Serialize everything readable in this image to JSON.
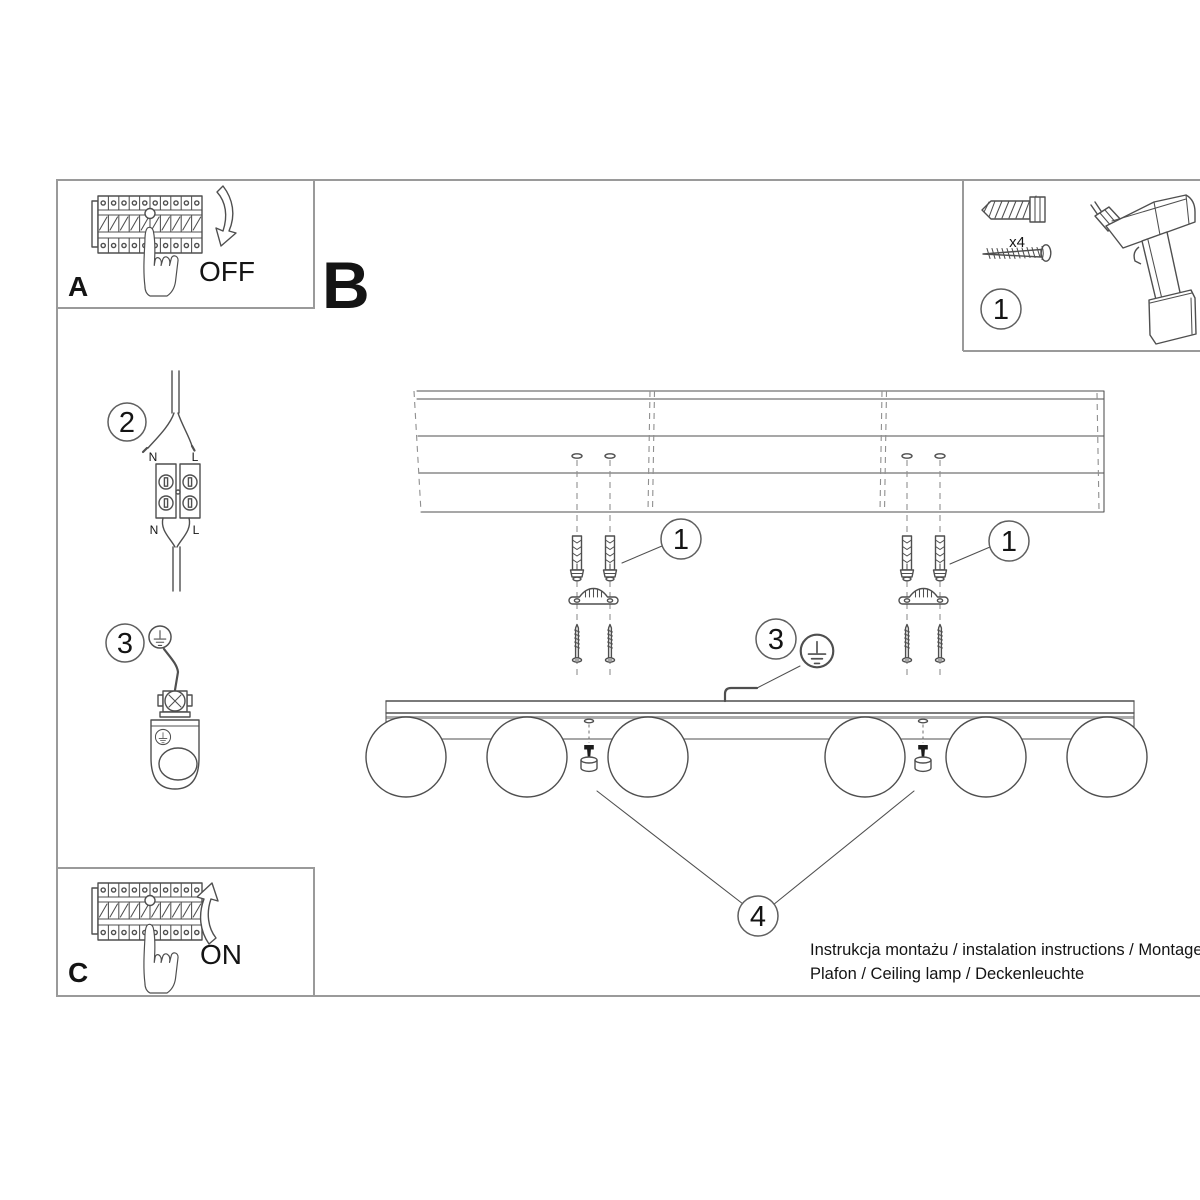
{
  "panel_a": {
    "label": "A",
    "action": "OFF"
  },
  "section_b": {
    "label": "B"
  },
  "panel_c": {
    "label": "C",
    "action": "ON"
  },
  "tools_panel": {
    "callout": "1",
    "anchor_quantity": "x4"
  },
  "wiring_step": {
    "callout": "2",
    "top_left_terminal": "N",
    "top_right_terminal": "L",
    "bottom_left_terminal": "N",
    "bottom_right_terminal": "L"
  },
  "ground_step": {
    "callout": "3"
  },
  "assembly": {
    "anchors_callout_left": "1",
    "anchors_callout_right": "1",
    "ground_callout": "3",
    "decor_screws_callout": "4"
  },
  "footer": {
    "line1": "Instrukcja montażu / instalation instructions / Montageanleitung",
    "line2": "Plafon / Ceiling lamp / Deckenleuchte"
  }
}
